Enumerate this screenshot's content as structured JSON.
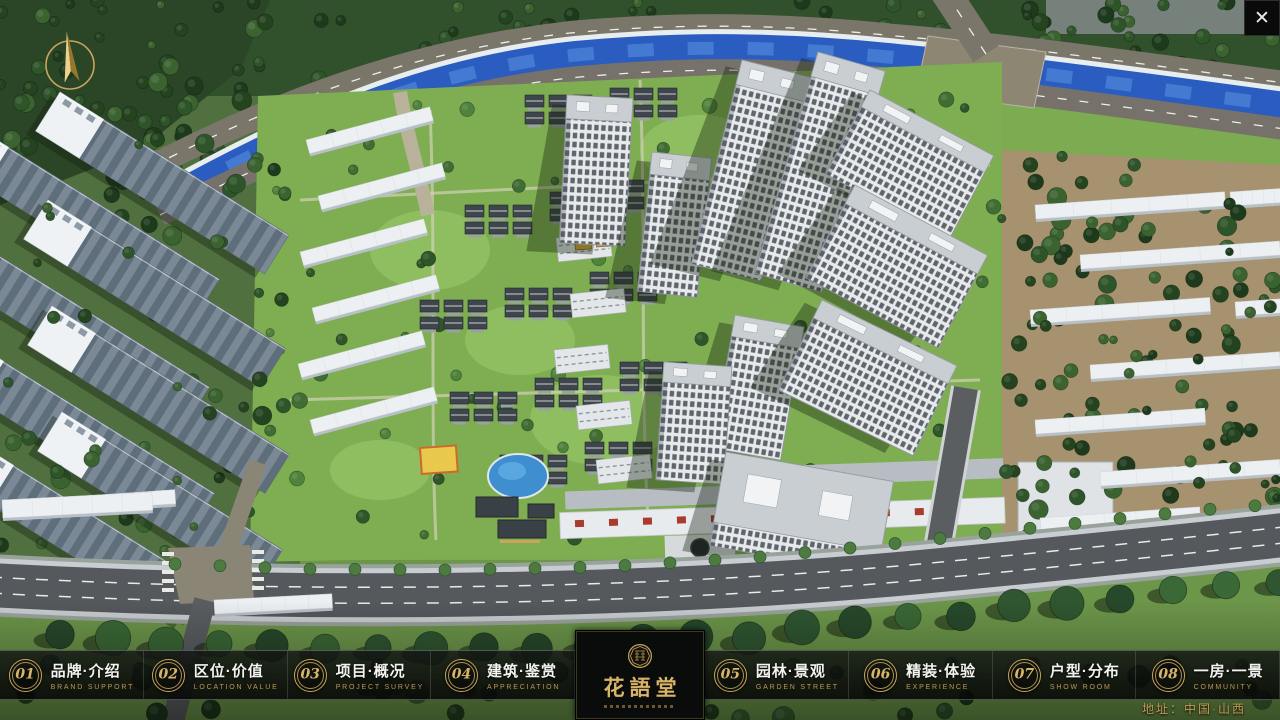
{
  "colors": {
    "gold": "#c9a55e",
    "gold_bright": "#d9b56a",
    "nav_bg": "#0b0d0c",
    "red_accent": "#a83a2e",
    "water": "#2b5cc0",
    "lawn": "#7fae52"
  },
  "icons": {
    "close": "✕",
    "compass": "north-arrow",
    "seal": "seal-emblem"
  },
  "nav": {
    "items": [
      {
        "num": "01",
        "zh": "品牌·介绍",
        "en": "BRAND SUPPORT"
      },
      {
        "num": "02",
        "zh": "区位·价值",
        "en": "LOCATION VALUE"
      },
      {
        "num": "03",
        "zh": "项目·概况",
        "en": "PROJECT SURVEY"
      },
      {
        "num": "04",
        "zh": "建筑·鉴赏",
        "en": "APPRECIATION"
      },
      {
        "num": "05",
        "zh": "园林·景观",
        "en": "GARDEN STREET"
      },
      {
        "num": "06",
        "zh": "精装·体验",
        "en": "EXPERIENCE"
      },
      {
        "num": "07",
        "zh": "户型·分布",
        "en": "SHOW ROOM"
      },
      {
        "num": "08",
        "zh": "一房·一景",
        "en": "COMMUNITY"
      }
    ]
  },
  "logo": {
    "title": "花語堂"
  },
  "footer": {
    "address": "地址：中国·山西"
  }
}
